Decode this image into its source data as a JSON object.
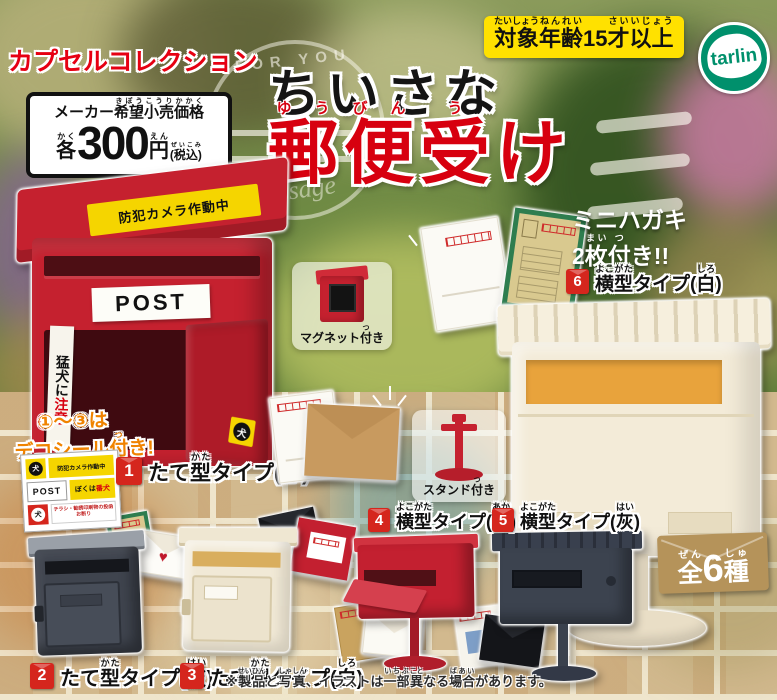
{
  "colors": {
    "brand_red": "#e60012",
    "title_red": "#d7000f",
    "accent_yellow": "#ffe100",
    "tarlin_green": "#00906c",
    "mailbox_red": "#c5212f",
    "cream": "#f3ebd8",
    "dark_gray": "#3f444e",
    "badge_tan": "#b5935a",
    "number_badge_red": "#d5261d"
  },
  "header": {
    "brand": "カプセルコレクション",
    "price": {
      "label": [
        {
          "t": "メーカー"
        },
        {
          "t": "希望",
          "rt": "きぼう"
        },
        {
          "t": "小売",
          "rt": "こうり"
        },
        {
          "t": "価格",
          "rt": "かかく"
        }
      ],
      "each": [
        {
          "t": "各",
          "rt": "かく"
        }
      ],
      "amount": "300",
      "yen": [
        {
          "t": "円",
          "rt": "えん"
        }
      ],
      "tax": [
        {
          "t": "(税込)",
          "rt": "ぜいこみ"
        }
      ]
    },
    "age": [
      {
        "t": "対象",
        "rt": "たいしょう"
      },
      {
        "t": "年齢",
        "rt": "ねんれい"
      },
      {
        "t": "15"
      },
      {
        "t": "才",
        "rt": "さい"
      },
      {
        "t": "以上",
        "rt": "いじょう"
      }
    ],
    "logo": "tarlin"
  },
  "title": {
    "small": "ちいさな",
    "main": [
      {
        "t": "郵",
        "rt": "ゆう"
      },
      {
        "t": "便",
        "rt": "びん"
      },
      {
        "t": "受",
        "rt": "う"
      },
      {
        "t": "け"
      }
    ]
  },
  "watermark": {
    "arc": "FOR YOU",
    "script": "message"
  },
  "mailbox_photo": {
    "camera_sticker": "防犯カメラ作動中",
    "post": "POST",
    "side_black": "猛犬に",
    "side_red": "注意",
    "dog": "犬"
  },
  "deco": {
    "line1": "①〜③は",
    "line2": [
      {
        "t": "デコシール"
      },
      {
        "t": "付",
        "rt": "つ"
      },
      {
        "t": "き!"
      }
    ]
  },
  "sticker_sheet": {
    "dog1": "犬",
    "camera": "防犯カメラ作動中",
    "post": "POST",
    "watchdog_black": "ぼくは",
    "watchdog_red": "番犬",
    "dog2": "犬",
    "no_flyer": "チラシ・勧誘印刷物の投函お断り"
  },
  "callouts": {
    "magnet": [
      {
        "t": "マグネット"
      },
      {
        "t": "付",
        "rt": "つ"
      },
      {
        "t": "き"
      }
    ],
    "stand": [
      {
        "t": "スタンド"
      },
      {
        "t": "付",
        "rt": "つ"
      },
      {
        "t": "き"
      }
    ],
    "postcards_line1": "ミニハガキ",
    "postcards_line2": [
      {
        "t": "2"
      },
      {
        "t": "枚",
        "rt": "まい"
      },
      {
        "t": "付",
        "rt": "つ"
      },
      {
        "t": "き!!"
      }
    ]
  },
  "items": [
    {
      "num": "1",
      "label": [
        {
          "t": "たて"
        },
        {
          "t": "型",
          "rt": "かた"
        },
        {
          "t": "タイプ("
        },
        {
          "t": "赤",
          "rt": "あか"
        },
        {
          "t": ")"
        }
      ]
    },
    {
      "num": "2",
      "label": [
        {
          "t": "たて"
        },
        {
          "t": "型",
          "rt": "かた"
        },
        {
          "t": "タイプ("
        },
        {
          "t": "灰",
          "rt": "はい"
        },
        {
          "t": ")"
        }
      ]
    },
    {
      "num": "3",
      "label": [
        {
          "t": "たて"
        },
        {
          "t": "型",
          "rt": "かた"
        },
        {
          "t": "タイプ("
        },
        {
          "t": "白",
          "rt": "しろ"
        },
        {
          "t": ")"
        }
      ]
    },
    {
      "num": "4",
      "label": [
        {
          "t": "横型",
          "rt": "よこがた"
        },
        {
          "t": "タイプ("
        },
        {
          "t": "赤",
          "rt": "あか"
        },
        {
          "t": ")"
        }
      ]
    },
    {
      "num": "5",
      "label": [
        {
          "t": "横型",
          "rt": "よこがた"
        },
        {
          "t": "タイプ("
        },
        {
          "t": "灰",
          "rt": "はい"
        },
        {
          "t": ")"
        }
      ]
    },
    {
      "num": "6",
      "label": [
        {
          "t": "横型",
          "rt": "よこがた"
        },
        {
          "t": "タイプ("
        },
        {
          "t": "白",
          "rt": "しろ"
        },
        {
          "t": ")"
        }
      ]
    }
  ],
  "set_badge": [
    {
      "t": "全",
      "rt": "ぜん"
    },
    {
      "t": "6"
    },
    {
      "t": "種",
      "rt": "しゅ"
    }
  ],
  "footer": {
    "disclaimer": [
      {
        "t": "※"
      },
      {
        "t": "製品",
        "rt": "せいひん"
      },
      {
        "t": "と"
      },
      {
        "t": "写真",
        "rt": "しゃしん"
      },
      {
        "t": "、イラストは"
      },
      {
        "t": "一部",
        "rt": "いちぶ"
      },
      {
        "t": "異",
        "rt": "こと"
      },
      {
        "t": "なる"
      },
      {
        "t": "場合",
        "rt": "ばあい"
      },
      {
        "t": "があります。"
      }
    ]
  }
}
